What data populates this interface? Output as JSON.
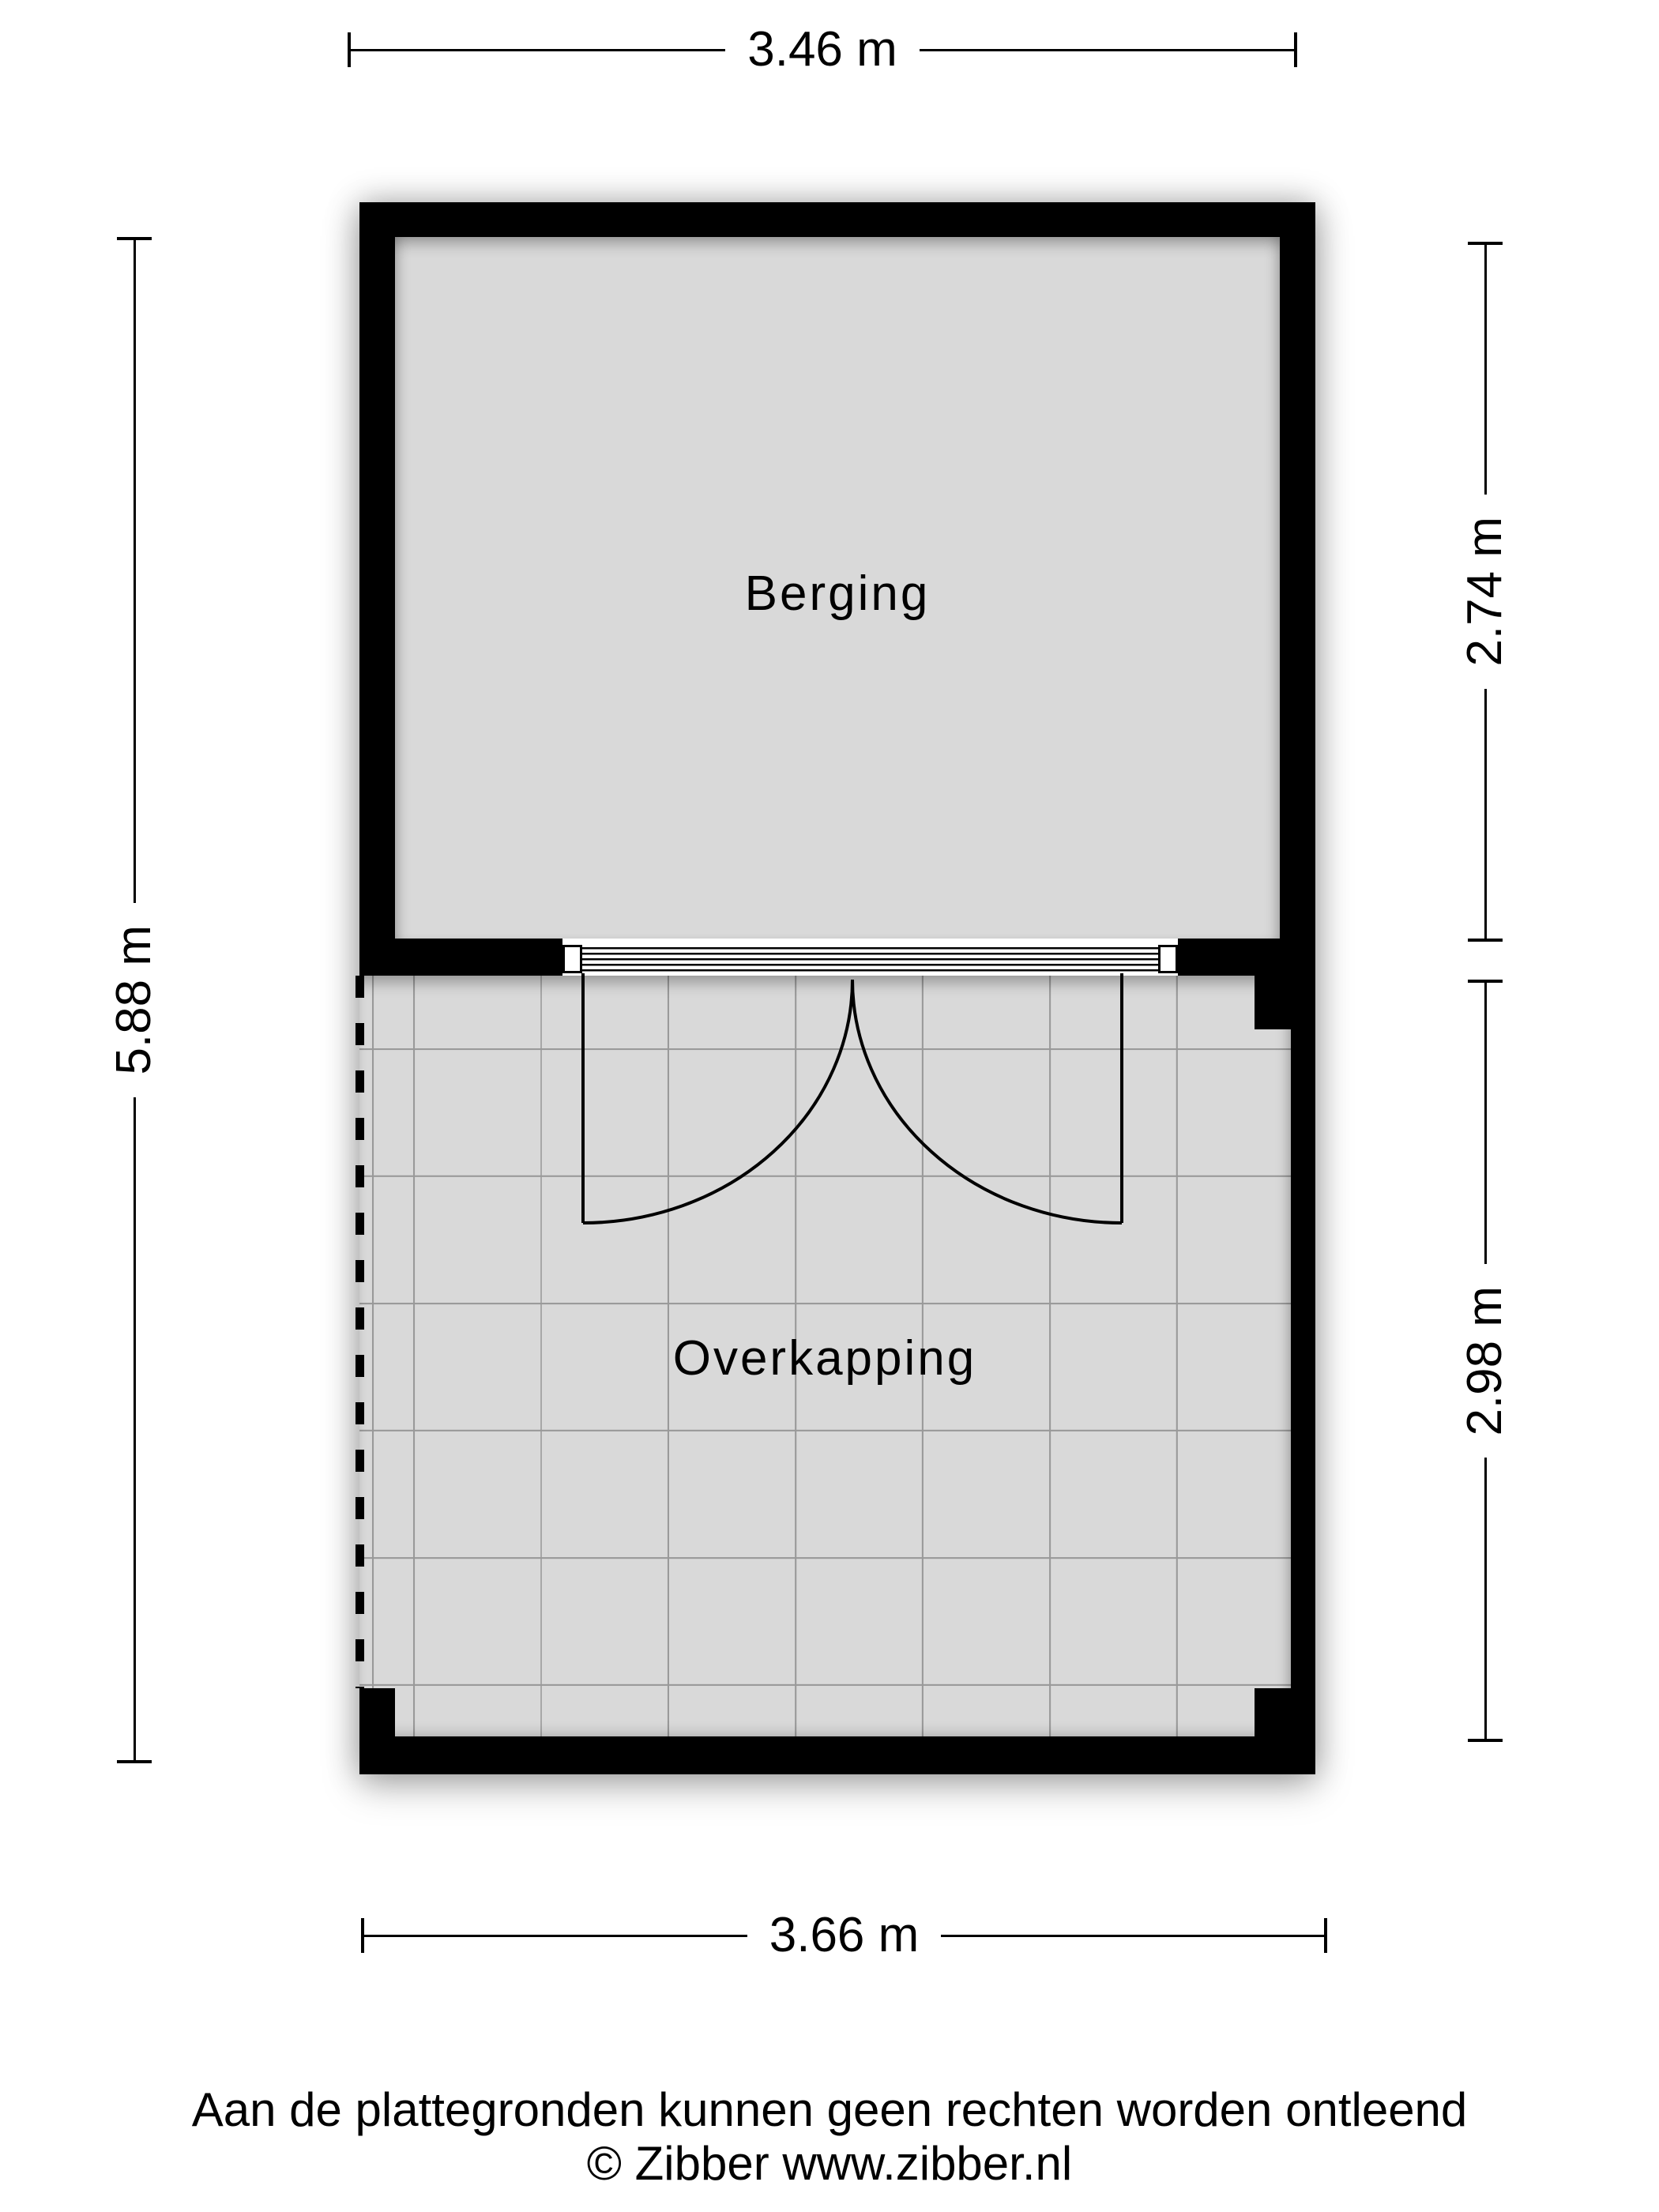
{
  "colors": {
    "wall": "#000000",
    "floor": "#d9d9d9",
    "tile_grid_line": "#999999",
    "dimension_line": "#000000",
    "text": "#000000",
    "background": "#ffffff"
  },
  "rooms": [
    {
      "name": "Berging"
    },
    {
      "name": "Overkapping"
    }
  ],
  "dimensions": {
    "top": {
      "label": "3.46 m"
    },
    "left": {
      "label": "5.88 m"
    },
    "right_upper": {
      "label": "2.74 m"
    },
    "right_lower": {
      "label": "2.98 m"
    },
    "bottom": {
      "label": "3.66 m"
    }
  },
  "footer": {
    "disclaimer": "Aan de plattegronden kunnen geen rechten worden ontleend",
    "copyright": "© Zibber www.zibber.nl"
  }
}
